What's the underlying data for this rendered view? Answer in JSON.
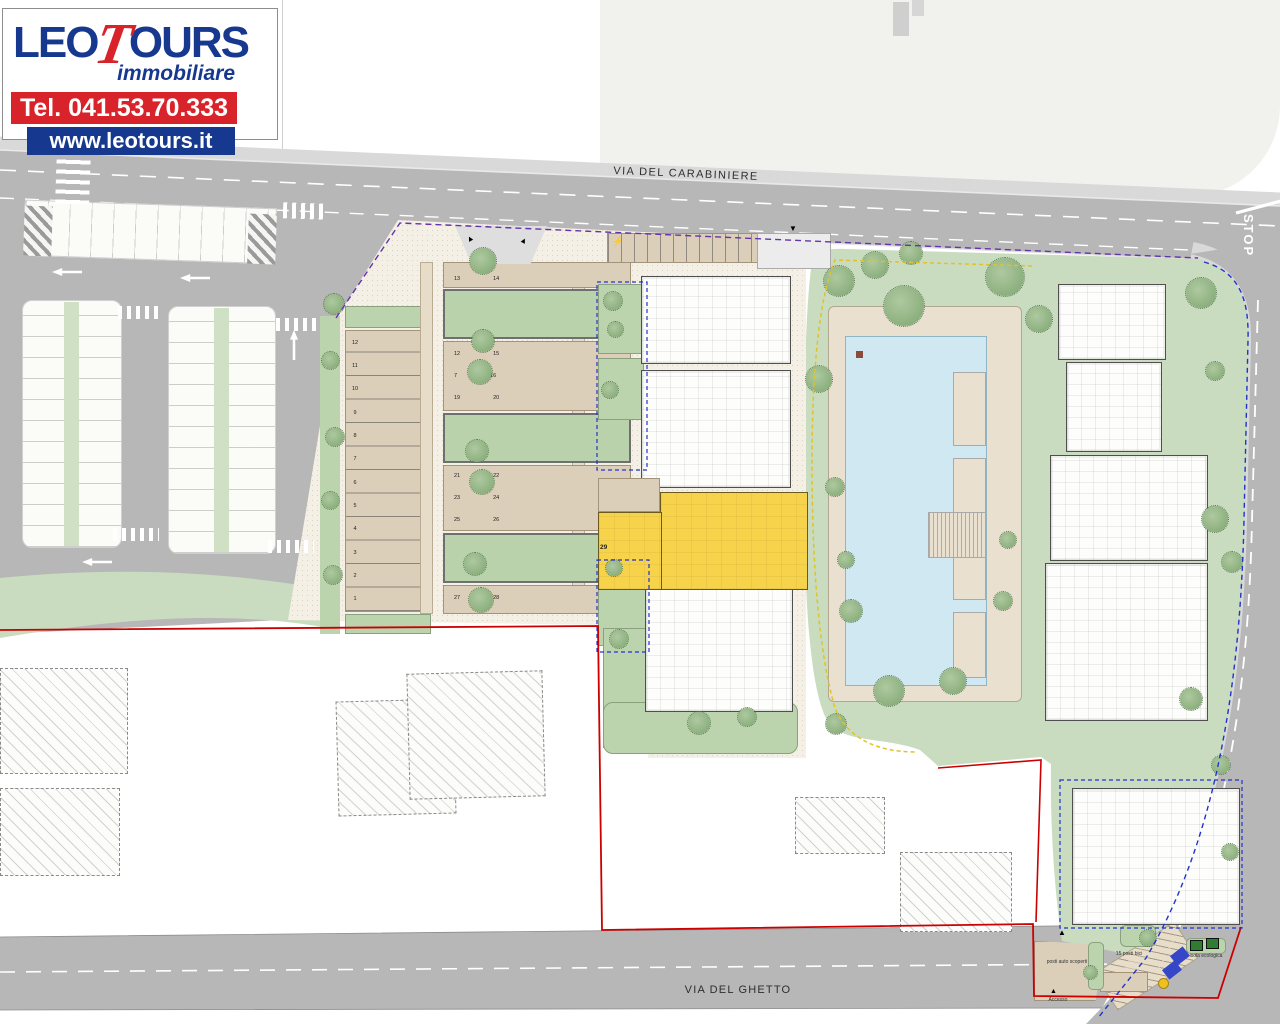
{
  "branding": {
    "brand_part1": "LEO",
    "brand_t": "T",
    "brand_part2": "OURS",
    "tagline": "immobiliare",
    "phone": "Tel. 041.53.70.333",
    "website": "www.leotours.it",
    "brand_blue": "#16388e",
    "brand_red": "#d8232a"
  },
  "roads": {
    "top_label": "VIA DEL CARABINIERE",
    "bottom_label": "VIA DEL GHETTO",
    "stop_marking": "STOP"
  },
  "site": {
    "highlighted_unit": "29",
    "left_stalls": [
      "12",
      "11",
      "10",
      "9",
      "8",
      "7",
      "6",
      "5",
      "4",
      "3",
      "2",
      "1"
    ],
    "garage_rows": [
      {
        "l": "13",
        "r": "14"
      },
      {
        "l": "12",
        "r": "15"
      },
      {
        "l": "7",
        "r": "16"
      },
      {
        "l": "19",
        "r": "20"
      },
      {
        "l": "21",
        "r": "22"
      },
      {
        "l": "23",
        "r": "24"
      },
      {
        "l": "25",
        "r": "26"
      },
      {
        "l": "27",
        "r": "28"
      }
    ]
  },
  "annotations": {
    "uncovered_parking": "posti auto scoperti",
    "bike_parking": "15 posti bici",
    "eco_island": "isola ecologica",
    "access": "Accesso"
  },
  "colors": {
    "road": "#b7b7b7",
    "lawn": "#c9dcc0",
    "pool": "#cfe8f2",
    "highlight": "#f7d34b",
    "boundary_red": "#cc0000",
    "boundary_blue": "#2233cc",
    "boundary_purple": "#6633aa",
    "boundary_yellow": "#e0c22c"
  }
}
